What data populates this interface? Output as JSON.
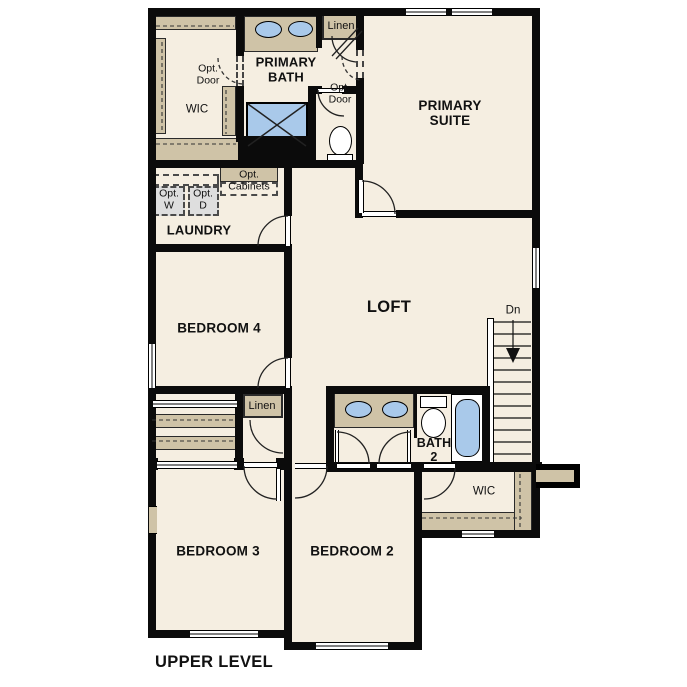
{
  "title": "UPPER LEVEL",
  "rooms": {
    "primary_suite": "PRIMARY\nSUITE",
    "primary_bath": "PRIMARY\nBATH",
    "wic_primary": "WIC",
    "laundry": "LAUNDRY",
    "loft": "LOFT",
    "bedroom_4": "BEDROOM 4",
    "bedroom_3": "BEDROOM 3",
    "bedroom_2": "BEDROOM 2",
    "bath_2": "BATH\n2",
    "wic_bedroom_2": "WIC"
  },
  "closets": {
    "linen_upper": "Linen",
    "linen_hall": "Linen"
  },
  "options": {
    "opt_door_wic": "Opt.\nDoor",
    "opt_door_suite": "Opt.\nDoor",
    "opt_washer": "Opt.\nW",
    "opt_dryer": "Opt.\nD",
    "opt_cabinets": "Opt.\nCabinets"
  },
  "stairs": {
    "direction": "Dn"
  },
  "colors": {
    "wall": "#0b0b0b",
    "floor": "#f5eee1",
    "cabinet": "#cfc3a7",
    "fixture_blue": "#a9c9ea",
    "optional_gray": "#dedede",
    "background": "#ffffff"
  }
}
